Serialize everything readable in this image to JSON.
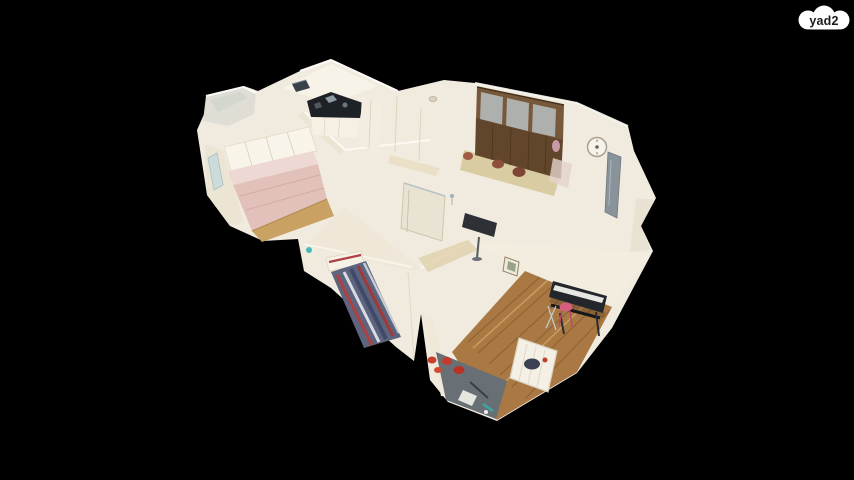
{
  "page": {
    "width": 854,
    "height": 480,
    "background_color": "#000000"
  },
  "logo": {
    "text": "yad2",
    "bubble_color": "#ffffff",
    "text_color": "#1c1c1c"
  },
  "scene": {
    "type": "3d-dollhouse-tour",
    "rooms": [
      {
        "name": "balcony"
      },
      {
        "name": "pink-bedroom"
      },
      {
        "name": "kitchen"
      },
      {
        "name": "hallway"
      },
      {
        "name": "dining-room"
      },
      {
        "name": "bathroom"
      },
      {
        "name": "striped-bed-bedroom"
      },
      {
        "name": "living-room"
      }
    ],
    "palette": {
      "wall": "#f1ebdf",
      "wall_bright": "#fbf8f1",
      "wall_shade": "#ece5d4",
      "counter_dark": "#1e2126",
      "hutch_wood": "#62462c",
      "hutch_frame": "#77583a",
      "glass_pane": "#b6bfc1",
      "pink_bed": "#e2c1ba",
      "pink_pillow": "#eed8d3",
      "bedroom_wood": "#c9a263",
      "living_wood": "#a97843",
      "bed_blue": "#5d647d",
      "stripe_red": "#b04040",
      "keyboard_dark": "#23262b",
      "stool_pink": "#d75f7d",
      "crib_white": "#f4f0e6",
      "rug_gray": "#687075",
      "pillow_red": "#c33b2c",
      "teal_accent": "#47b8bc",
      "clock_face": "#f6f3ea",
      "tv_dark": "#2d3136"
    }
  }
}
